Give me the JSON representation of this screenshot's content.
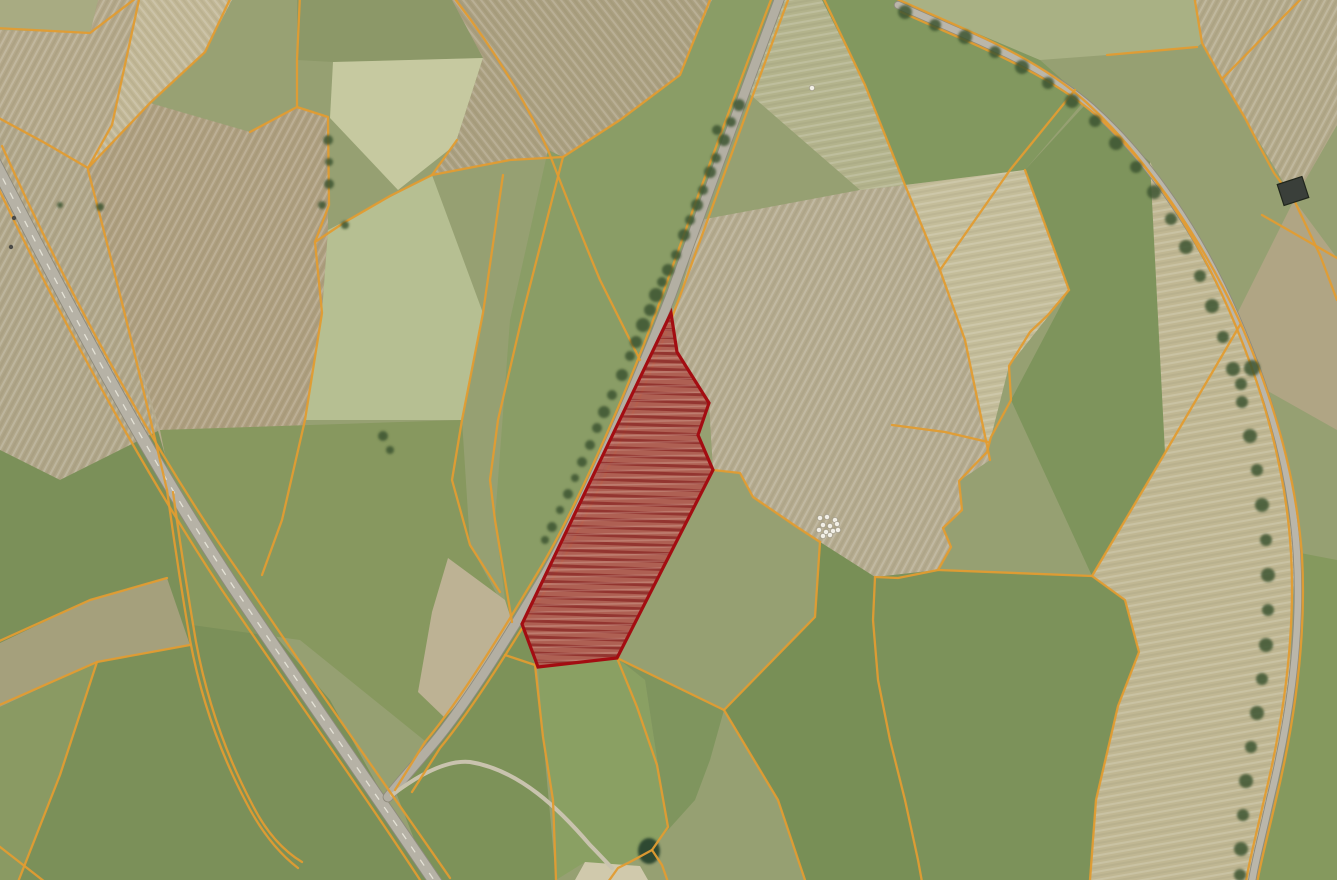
{
  "meta": {
    "description": "Aerial photograph map view with cadastral parcel boundaries drawn in orange and one selected parcel highlighted in red; no text, buttons or UI chrome are visible",
    "map_type": "satellite-with-cadastre-overlay",
    "visible_text": "none"
  },
  "map": {
    "width": 1337,
    "height": 880,
    "palette": {
      "base": "#96a072",
      "boundary": "#e29c31",
      "road_fill": "#b6b2a6",
      "road_casing": "#8e8a7c",
      "road_centerline": "#eceade",
      "tree": "#3e5530",
      "parcel_fill": "#b05a50",
      "parcel_stroke": "#a30d12",
      "bale": "#f2efe6",
      "pond": "#2e4a33",
      "gravel": "#d6cdb2",
      "building": "#3a3f3a",
      "vehicle": "#4a4a46"
    },
    "fields": [
      {
        "p": "0,0 98,0 90,33 0,30",
        "f": "#a8ab82",
        "t": ""
      },
      {
        "p": "98,0 140,0 112,125 88,168 45,143 0,118 0,30 90,33",
        "f": "#b4a88a",
        "t": "A"
      },
      {
        "p": "140,0 232,0 205,52 150,103 88,168 112,125",
        "f": "#c2b897",
        "t": "B"
      },
      {
        "p": "232,0 300,0 297,107 250,132 150,103 205,52",
        "f": "#98a173",
        "t": ""
      },
      {
        "p": "300,0 452,0 483,58 333,62 297,60 297,0",
        "f": "#8c9868",
        "t": ""
      },
      {
        "p": "333,62 483,58 455,145 398,190 330,118",
        "f": "#c6c9a0",
        "t": ""
      },
      {
        "p": "452,0 712,0 680,75 620,120 563,157 510,160 432,175 455,145 483,58",
        "f": "#aba081",
        "t": "B"
      },
      {
        "p": "548,150 563,157 620,120 680,75 712,0 782,0 745,90 671,295 640,375 585,505 545,575 512,622 505,600 495,520 510,320",
        "f": "#8a9d66",
        "t": ""
      },
      {
        "p": "700,220 860,190 905,185 940,270 965,340 990,460 959,481 962,510 943,528 951,547 938,570 875,577 820,542 797,527 753,497 740,473 713,470 709,403 677,352 671,313 680,296",
        "f": "#b5ab8f",
        "t": "A"
      },
      {
        "p": "88,168 150,103 250,132 297,107 328,117 328,230 322,313 305,420 270,560 192,625 165,455 118,293",
        "f": "#ae9f80",
        "t": "A"
      },
      {
        "p": "328,230 432,175 483,313 462,420 305,420 322,313",
        "f": "#b6bf92",
        "t": ""
      },
      {
        "p": "0,118 45,143 88,168 118,293 160,430 60,480 0,450",
        "f": "#b0a689",
        "t": "A"
      },
      {
        "p": "0,450 60,480 160,430 233,586 330,700 430,880 0,880",
        "f": "#7b9059",
        "t": ""
      },
      {
        "p": "118,293 165,455 233,586 160,430",
        "f": "#b5aa8c",
        "t": ""
      },
      {
        "p": "160,430 462,420 470,545 512,622 430,745 300,640 192,625 165,455",
        "f": "#87985f",
        "t": ""
      },
      {
        "p": "782,0 822,0 865,85 905,185 860,190 745,90",
        "f": "#b3b38c",
        "t": "C"
      },
      {
        "p": "822,0 898,0 1040,60 1085,100 1025,170 905,185 865,85",
        "f": "#82985f",
        "t": ""
      },
      {
        "p": "898,0 1100,0 1194,0 1202,43 1197,47 1107,55 1040,60",
        "f": "#a9b184",
        "t": ""
      },
      {
        "p": "1194,0 1337,0 1337,125 1294,200 1245,118 1222,79 1202,43",
        "f": "#b3a98a",
        "t": "A"
      },
      {
        "p": "905,185 1025,170 1069,290 1009,366 991,437 987,452 965,340 940,270",
        "f": "#c4bd9a",
        "t": "C"
      },
      {
        "p": "1025,170 1085,105 1150,162 1235,318 1165,453 1092,576 1011,400 1069,290",
        "f": "#7e945c",
        "t": ""
      },
      {
        "p": "1150,162 1235,318 1266,390 1295,552 1287,730 1268,800 1252,882 1090,880 1096,800 1118,706 1139,652 1125,600 1092,576 1165,453",
        "f": "#c0b793",
        "t": "C"
      },
      {
        "p": "1294,200 1337,258 1337,430 1266,390 1235,318",
        "f": "#b0a584",
        "t": ""
      },
      {
        "p": "1295,552 1302,640 1275,804 1257,884 1337,884 1337,560",
        "f": "#85995e",
        "t": ""
      },
      {
        "p": "535,665 543,737 556,880 430,880 395,790 445,718 497,657 522,624",
        "f": "#7d9259",
        "t": ""
      },
      {
        "p": "538,667 617,658 645,680 668,830 652,850 620,865 585,862 556,880 553,800 543,737",
        "f": "#8aa063",
        "t": ""
      },
      {
        "p": "617,658 724,710 710,760 695,800 668,830 645,680",
        "f": "#7f955e",
        "t": ""
      },
      {
        "p": "724,710 815,617 820,542 875,577 873,620 890,740 918,860 922,882 805,880 778,800",
        "f": "#788f56",
        "t": ""
      },
      {
        "p": "938,570 1092,576 1125,600 1139,652 1118,706 1096,800 1090,880 922,882 918,860 905,800 890,740 878,680 873,620 875,577",
        "f": "#7c925a",
        "t": ""
      },
      {
        "p": "448,558 505,600 512,622 497,657 445,718 418,692 432,612",
        "f": "#bdb294",
        "t": ""
      },
      {
        "p": "0,643 90,600 167,578 190,645 97,662 0,707",
        "f": "#a5a07c",
        "t": ""
      },
      {
        "p": "0,707 97,662 60,775 18,882 0,882",
        "f": "#8a9a63",
        "t": ""
      }
    ],
    "roads": [
      {
        "name": "main-road-west",
        "path": "M -12,150 C 40,250 130,430 233,586 C 320,715 380,800 438,886",
        "width": 12,
        "fill": "#b6b2a6",
        "casing": "#8e8a7c",
        "center": true
      },
      {
        "name": "road-center",
        "path": "M 782,-8 C 745,90 700,215 671,295 C 640,375 585,505 545,575 C 515,625 470,700 432,745 C 417,763 400,782 388,797",
        "width": 9,
        "fill": "#b3afa3",
        "casing": "#8f8b7d",
        "center": false
      },
      {
        "name": "road-northeast",
        "path": "M 898,5 C 970,38 1040,62 1092,108 C 1150,160 1200,235 1235,315 C 1268,390 1292,470 1297,555 C 1302,645 1287,730 1270,800 C 1260,845 1254,866 1252,882",
        "width": 6.5,
        "fill": "#bab6aa",
        "casing": "#8f8b7d",
        "center": false
      },
      {
        "name": "farm-track",
        "path": "M 392,795 C 425,770 450,760 470,762 C 520,770 560,810 590,845 C 600,855 606,862 612,868",
        "width": 4,
        "fill": "#c9c3ae",
        "casing": "",
        "center": false
      }
    ],
    "boundaries": [
      "M -14,162 C 28,252 118,432 222,590 C 308,716 368,800 424,886",
      "M 2,146 C 44,240 132,420 243,578 C 330,708 392,794 450,878",
      "M 774,-8 C 738,86 692,212 663,293 C 632,380 578,506 538,572 C 508,622 463,697 425,742 L 395,790",
      "M 791,-8 C 753,94 708,218 680,296 C 648,383 593,508 553,578 C 523,627 478,702 440,748 L 412,792",
      "M 897,-1 C 965,30 1036,56 1087,103 C 1144,155 1194,230 1229,310 C 1262,386 1286,468 1291,553 C 1296,644 1281,731 1264,800 C 1254,844 1248,866 1246,882",
      "M 901,12 C 972,44 1043,70 1096,115 C 1152,166 1202,240 1240,322 C 1272,395 1296,474 1302,556 C 1307,646 1292,734 1275,804 C 1265,847 1259,869 1257,884",
      "M 140,-5 L 112,125 L 88,168",
      "M 88,168 L 150,103 L 205,52 L 232,-5",
      "M -5,28 L 90,33 L 140,-5",
      "M -5,116 L 45,143 L 88,168",
      "M 88,170 Q 125,310 167,490",
      "M 167,490 Q 178,570 190,640 Q 206,726 246,802 Q 268,845 298,868",
      "M 173,492 Q 184,572 196,642 Q 212,728 252,804 Q 272,844 302,862",
      "M 18,882 L 60,775 L 97,662 L 190,645",
      "M -5,707 L 97,662",
      "M -5,643 L 90,600 L 167,578",
      "M -5,843 L 45,882",
      "M 300,-5 L 297,60 L 297,107",
      "M 297,107 L 250,132",
      "M 297,107 L 328,117 L 329,205 L 315,242 L 322,313 L 305,420 L 282,520 L 262,575",
      "M 452,-5 Q 512,72 548,150 Q 575,220 600,280 L 640,360",
      "M 457,140 L 432,175 L 390,196 L 345,222 L 315,242",
      "M 432,175 L 510,160 L 563,157",
      "M 563,157 L 620,120 L 680,75 L 712,-5",
      "M 503,175 L 483,313 L 462,420 L 452,480 L 470,545 L 500,592",
      "M 563,157 L 523,313 L 498,420 L 490,480 L 495,520 L 512,622",
      "M 822,-5 L 865,85 L 905,185 L 940,270 L 965,340 L 990,460",
      "M 1075,90 L 1010,170 L 940,270",
      "M 1069,290 L 1048,315 L 1030,332 L 1009,366 L 1011,400 L 991,437 L 987,452 L 959,481 L 962,510 L 943,528 L 951,547 L 938,570 L 898,578 L 875,577",
      "M 875,577 L 873,620 L 878,680 L 890,740 L 905,800 L 918,860 L 922,882",
      "M 1025,170 L 1069,290",
      "M 1240,325 L 1165,453 L 1092,576 L 1125,600 L 1139,652 L 1118,706 L 1096,800 L 1090,880",
      "M 713,470 L 740,473 L 753,497 L 797,527 L 820,542",
      "M 820,542 L 815,617 L 724,710",
      "M 617,658 L 724,710",
      "M 724,710 L 778,800 L 805,880",
      "M 617,658 L 637,707 L 657,765 L 668,827 L 652,850",
      "M 652,850 L 630,862 L 618,868 L 608,882",
      "M 652,850 L 662,865 L 668,882",
      "M 535,665 L 543,737 L 553,800 L 556,880",
      "M 535,665 L 505,655",
      "M 1107,55 L 1197,47",
      "M 1194,-5 L 1202,43 L 1222,79",
      "M 1222,79 L 1290,10 L 1305,-5",
      "M 1222,79 L 1245,118 L 1260,147 L 1274,173 L 1294,200 L 1320,255 L 1337,300",
      "M 1262,215 L 1337,258",
      "M 892,425 L 945,432 L 988,442",
      "M 938,570 L 1092,576"
    ],
    "trees": [
      [
        739,
        105,
        6
      ],
      [
        731,
        122,
        5
      ],
      [
        724,
        140,
        6
      ],
      [
        717,
        130,
        5
      ],
      [
        716,
        158,
        5
      ],
      [
        710,
        172,
        6
      ],
      [
        703,
        190,
        5
      ],
      [
        697,
        205,
        6
      ],
      [
        690,
        220,
        5
      ],
      [
        684,
        235,
        6
      ],
      [
        676,
        255,
        5
      ],
      [
        668,
        270,
        6
      ],
      [
        662,
        282,
        5
      ],
      [
        656,
        295,
        7
      ],
      [
        650,
        310,
        6
      ],
      [
        643,
        325,
        7
      ],
      [
        636,
        342,
        6
      ],
      [
        630,
        356,
        5
      ],
      [
        622,
        375,
        6
      ],
      [
        612,
        395,
        5
      ],
      [
        604,
        412,
        6
      ],
      [
        597,
        428,
        5
      ],
      [
        590,
        445,
        5
      ],
      [
        582,
        462,
        5
      ],
      [
        575,
        478,
        4
      ],
      [
        568,
        494,
        5
      ],
      [
        560,
        510,
        4
      ],
      [
        552,
        527,
        5
      ],
      [
        545,
        540,
        4
      ],
      [
        905,
        12,
        7
      ],
      [
        935,
        25,
        6
      ],
      [
        965,
        37,
        7
      ],
      [
        995,
        52,
        6
      ],
      [
        1022,
        67,
        7
      ],
      [
        1048,
        83,
        6
      ],
      [
        1072,
        101,
        7
      ],
      [
        1095,
        121,
        6
      ],
      [
        1116,
        143,
        7
      ],
      [
        1136,
        167,
        6
      ],
      [
        1154,
        192,
        7
      ],
      [
        1171,
        219,
        6
      ],
      [
        1186,
        247,
        7
      ],
      [
        1200,
        276,
        6
      ],
      [
        1212,
        306,
        7
      ],
      [
        1223,
        337,
        6
      ],
      [
        1233,
        369,
        7
      ],
      [
        1242,
        402,
        6
      ],
      [
        1250,
        436,
        7
      ],
      [
        1257,
        470,
        6
      ],
      [
        1262,
        505,
        7
      ],
      [
        1266,
        540,
        6
      ],
      [
        1268,
        575,
        7
      ],
      [
        1268,
        610,
        6
      ],
      [
        1266,
        645,
        7
      ],
      [
        1262,
        679,
        6
      ],
      [
        1257,
        713,
        7
      ],
      [
        1251,
        747,
        6
      ],
      [
        1246,
        781,
        7
      ],
      [
        1243,
        815,
        6
      ],
      [
        1241,
        849,
        7
      ],
      [
        1240,
        875,
        6
      ],
      [
        328,
        140,
        5
      ],
      [
        329,
        162,
        4
      ],
      [
        329,
        184,
        5
      ],
      [
        322,
        205,
        4
      ],
      [
        345,
        225,
        4
      ],
      [
        1252,
        368,
        8
      ],
      [
        1241,
        384,
        6
      ],
      [
        383,
        436,
        5
      ],
      [
        390,
        450,
        4
      ],
      [
        60,
        205,
        3
      ],
      [
        100,
        207,
        4
      ]
    ],
    "bales": [
      [
        820,
        518
      ],
      [
        827,
        517
      ],
      [
        835,
        520
      ],
      [
        823,
        525
      ],
      [
        830,
        526
      ],
      [
        837,
        524
      ],
      [
        819,
        530
      ],
      [
        826,
        532
      ],
      [
        833,
        531
      ],
      [
        838,
        530
      ],
      [
        823,
        536
      ],
      [
        830,
        535
      ],
      [
        812,
        88
      ]
    ],
    "vehicles": [
      [
        14,
        218
      ],
      [
        11,
        247
      ]
    ],
    "pond": {
      "cx": 649,
      "cy": 851,
      "rx": 11,
      "ry": 13
    },
    "gravel": "585,862 640,866 648,880 575,880",
    "building": {
      "x": 1280,
      "y": 180,
      "w": 26,
      "h": 22,
      "rotate": "-18 1293 191"
    },
    "selected_parcel": {
      "points": "671,313 677,352 709,403 698,435 713,470 617,658 538,667 522,624",
      "fill_opacity": 0.92,
      "stroke_width": 3.2
    }
  }
}
